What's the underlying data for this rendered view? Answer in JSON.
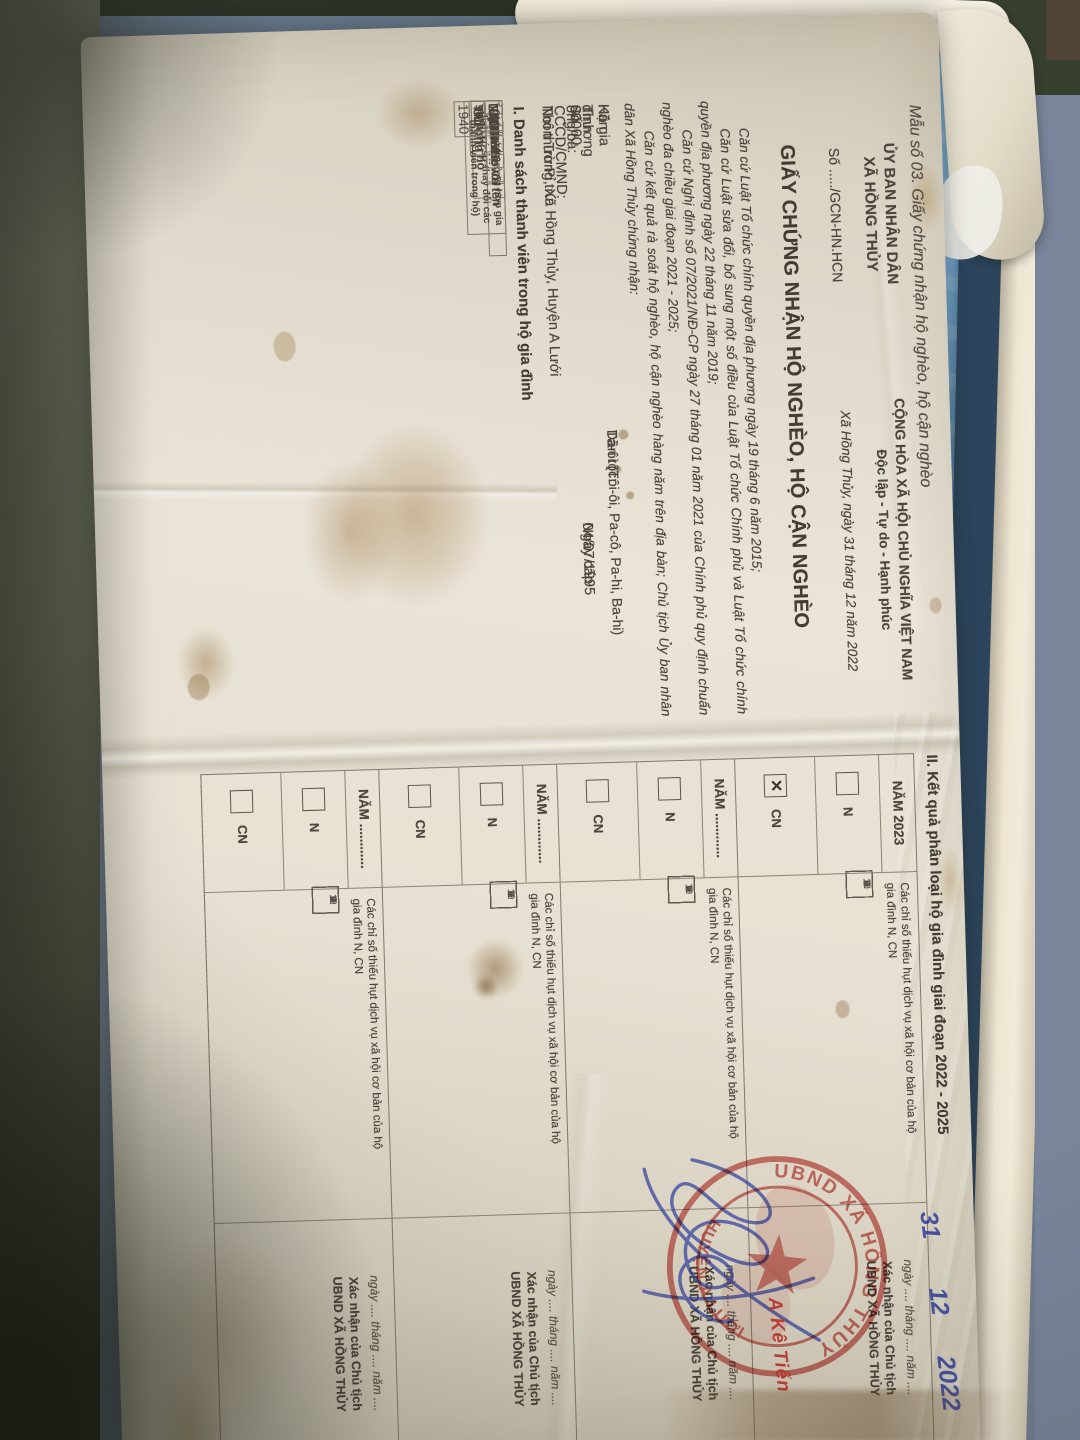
{
  "colors": {
    "stamp_red": "#c03a33",
    "ink_blue": "#2c3da0",
    "paper_white": "#ece8dd",
    "surface_blue": "#6fa3cf",
    "frame_cream": "#efe9d8"
  },
  "document": {
    "form_label": "Mẫu số 03. Giấy chứng nhận hộ nghèo, hộ cận nghèo",
    "header": {
      "issuer_line1": "ỦY BAN NHÂN DÂN",
      "issuer_line2": "XÃ HỒNG THỦY",
      "number_line": "Số ...../GCN-HN.HCN",
      "motto_line1": "CỘNG HÒA XÃ HỘI CHỦ NGHĨA VIỆT NAM",
      "motto_line2": "Độc lập - Tự do - Hạnh phúc",
      "dateline": "Xã Hồng Thủy, ngày 31 tháng 12 năm 2022"
    },
    "title": "GIẤY CHỨNG NHẬN HỘ NGHÈO, HỘ CẬN NGHÈO",
    "legal_bases": [
      "Căn cứ Luật Tổ chức chính quyền địa phương ngày 19 tháng 6 năm 2015;",
      "Căn cứ Luật sửa đổi, bổ sung một số điều của Luật Tổ chức Chính phủ và Luật Tổ chức chính quyền địa phương ngày 22 tháng 11 năm 2019;",
      "Căn cứ Nghị định số 07/2021/NĐ-CP ngày 27 tháng 01 năm 2021 của Chính phủ quy định chuẩn nghèo đa chiều giai đoạn 2021 - 2025;",
      "Căn cứ kết quả rà soát hộ nghèo, hộ cận nghèo hàng năm trên địa bàn; Chủ tịch Ủy ban nhân dân Xã Hồng Thủy chứng nhận:"
    ],
    "household": {
      "family_label": "Hộ gia đình ông/bà:",
      "family_name": "Kăn Thương",
      "ethnic_label": "Dân tộc:",
      "ethnic_value": "Tà-ôi (Tôi-ôi, Pa-cô, Pa-hi, Ba-hi)",
      "id_label": "Số CCCD/CMND:",
      "id_value": "00000",
      "issue_label": "Ngày cấp",
      "issue_value": "04/07/1995",
      "residence_label": "Nơi thường trú:",
      "residence_value": "Thôn Tru Pỉ, Xã Hồng Thủy, Huyện A Lưới"
    },
    "section1": {
      "heading": "I. Danh sách thành viên trong hộ gia đình",
      "table": {
        "col_stt": "STT",
        "col_name": "Họ và tên",
        "col_ethnic": "Dân tộc",
        "col_relation": "Quan hệ với chủ hộ",
        "col_birth": "Năm sinh",
        "col_male": "Nam",
        "col_female": "Nữ",
        "col_note": "Ghi chú (trường hợp gia đình có sự thay đổi các thành viên trong hộ)",
        "row1": {
          "stt": "1",
          "name": "Kăn Thương",
          "ethnic": "Tà-ôi",
          "relation": "Chủ Hộ",
          "male": "",
          "female": "01-01-1940",
          "note": ""
        }
      }
    },
    "section2": {
      "heading": "II. Kết quả phân loại hộ gia đình giai đoạn 2022 - 2025",
      "indices_label_line1": "Các chỉ số thiếu hụt dịch vụ xã hội cơ bản của hộ",
      "indices_label_line2": "gia đình N, CN",
      "index_numbers": [
        "1",
        "2",
        "3",
        "4",
        "5",
        "6",
        "7",
        "8",
        "9",
        "10",
        "11",
        "12"
      ],
      "blocks": [
        {
          "year_label": "NĂM 2023",
          "n_label": "N",
          "cn_label": "CN",
          "n_mark": "",
          "cn_mark": "✕"
        },
        {
          "year_label": "NĂM ............",
          "n_label": "N",
          "cn_label": "CN",
          "n_mark": "",
          "cn_mark": ""
        },
        {
          "year_label": "NĂM ............",
          "n_label": "N",
          "cn_label": "CN",
          "n_mark": "",
          "cn_mark": ""
        },
        {
          "year_label": "NĂM ............",
          "n_label": "N",
          "cn_label": "CN",
          "n_mark": "",
          "cn_mark": ""
        }
      ],
      "signature": {
        "date_line": "ngày .... tháng .... năm ....",
        "line1": "Xác nhận của Chủ tịch",
        "line2": "UBND XÃ HỒNG THỦY"
      }
    },
    "stamp": {
      "ring_top": "UBND XÃ HỒNG THỦY",
      "ring_bottom": "HUYỆN A LƯỚI"
    },
    "handwriting": {
      "day": "31",
      "month": "12",
      "year": "2022",
      "signed_name": "A Kê Tiến"
    }
  }
}
